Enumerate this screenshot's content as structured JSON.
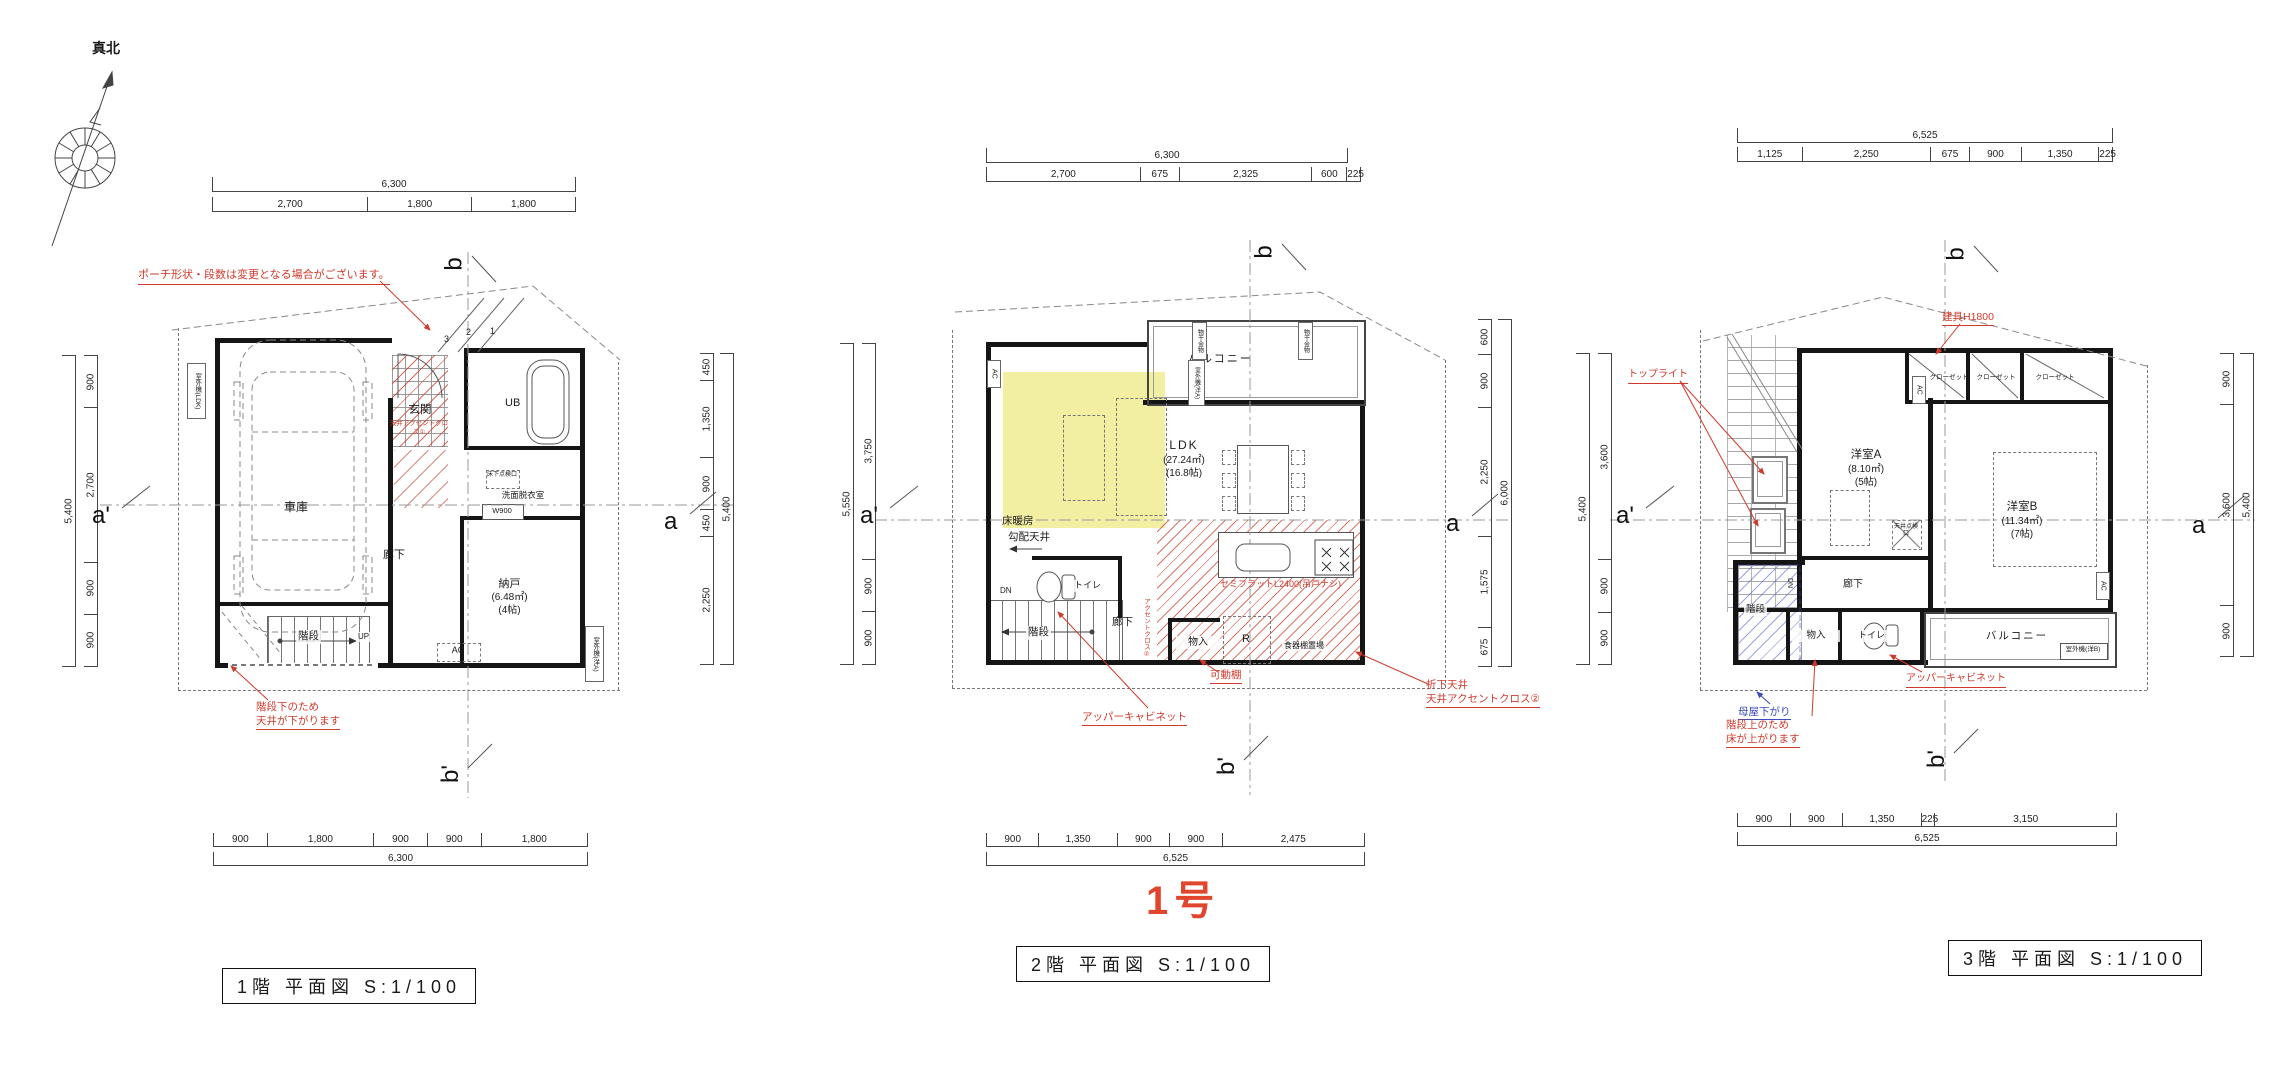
{
  "meta": {
    "north_label": "真北",
    "unit_label": "1号"
  },
  "plans": [
    {
      "id": "floor1",
      "title": "1階 平面図 S:1/100",
      "dims": {
        "top": {
          "total": "6,300",
          "segments": [
            "2,700",
            "1,800",
            "1,800"
          ]
        },
        "bottom": {
          "total": "6,300",
          "segments": [
            "900",
            "1,800",
            "900",
            "900",
            "1,800"
          ]
        },
        "left": {
          "total": "5,400",
          "segments": [
            "900",
            "2,700",
            "900",
            "900"
          ]
        },
        "right": {
          "total": "5,400",
          "segments": [
            "450",
            "1,350",
            "900",
            "450",
            "2,250"
          ]
        }
      },
      "markers": {
        "top": "b",
        "bottom": "b'",
        "left": "a'",
        "right": "a"
      },
      "rooms": {
        "garage": "車庫",
        "entrance": "玄関",
        "bath": "UB",
        "washroom": "洗面脱衣室",
        "corridor": "廊下",
        "storage": "納戸",
        "storage_area": "(6.48㎡)",
        "storage_size": "(4帖)",
        "stairs": "階段",
        "stairs_dir": "UP"
      },
      "fixtures": {
        "ac": "AC",
        "w900": "W900",
        "floor_hatch": "床下点検口",
        "outdoor_unit_ldk": "室外機(LDK)",
        "outdoor_unit_a": "室外機(洋A)"
      },
      "steps": [
        "3",
        "2",
        "1"
      ],
      "notes": {
        "porch": "ポーチ形状・段数は変更となる場合がございます。",
        "accent": "天井アクセントクロス①",
        "under_stairs": "階段下のため\n天井が下がります"
      }
    },
    {
      "id": "floor2",
      "title": "2階 平面図 S:1/100",
      "dims": {
        "top": {
          "total": "6,300",
          "segments": [
            "2,700",
            "675",
            "2,325",
            "600",
            "225"
          ]
        },
        "bottom": {
          "total": "6,525",
          "segments": [
            "900",
            "1,350",
            "900",
            "900",
            "2,475"
          ]
        },
        "left": {
          "total": "5,550",
          "segments": [
            "3,750",
            "900",
            "900"
          ]
        },
        "right": {
          "total": "6,000",
          "segments": [
            "600",
            "900",
            "2,250",
            "1,575",
            "675"
          ]
        }
      },
      "markers": {
        "top": "b",
        "bottom": "b'",
        "left": "a'",
        "right": "a"
      },
      "rooms": {
        "balcony": "バルコニー",
        "ldk": "LDK",
        "ldk_area": "(27.24㎡)",
        "ldk_size": "(16.8帖)",
        "floor_heating": "床暖房",
        "sloped_ceiling": "勾配天井",
        "toilet": "トイレ",
        "stairs": "階段",
        "stairs_dir": "DN",
        "corridor": "廊下",
        "closet": "物入",
        "fridge": "R",
        "cupboard": "食器棚置場"
      },
      "fixtures": {
        "ac": "AC",
        "laundry_hw": "物干金物",
        "outdoor_unit_a": "室外機(洋A)"
      },
      "notes": {
        "kitchen": "セミフラットL2400(吊戸ナシ)",
        "accent_wall": "アクセントクロス②",
        "movable_shelf": "可動棚",
        "upper_cabinet": "アッパーキャビネット",
        "folded_ceiling": "折下天井\n天井アクセントクロス②"
      }
    },
    {
      "id": "floor3",
      "title": "3階 平面図 S:1/100",
      "dims": {
        "top": {
          "total": "6,525",
          "segments": [
            "1,125",
            "2,250",
            "675",
            "900",
            "1,350",
            "225"
          ]
        },
        "bottom": {
          "total": "6,525",
          "segments": [
            "900",
            "900",
            "1,350",
            "225",
            "3,150"
          ]
        },
        "left": {
          "total": "5,400",
          "segments": [
            "3,600",
            "900",
            "900"
          ]
        },
        "right": {
          "total": "5,400",
          "segments": [
            "900",
            "3,600",
            "900"
          ]
        }
      },
      "markers": {
        "top": "b",
        "bottom": "b'",
        "left": "a'",
        "right": "a"
      },
      "rooms": {
        "room_a": "洋室A",
        "room_a_area": "(8.10㎡)",
        "room_a_size": "(5帖)",
        "room_b": "洋室B",
        "room_b_area": "(11.34㎡)",
        "room_b_size": "(7帖)",
        "closet": "クローゼット",
        "stairs": "階段",
        "stairs_dir": "DN",
        "storage": "物入",
        "toilet": "トイレ",
        "balcony": "バルコニー",
        "corridor": "廊下"
      },
      "fixtures": {
        "ac": "AC",
        "ceiling_hatch": "天井点検口",
        "outdoor_unit_b": "室外機(洋B)"
      },
      "notes": {
        "door": "建具H1800",
        "toplight": "トップライト",
        "upper_cabinet": "アッパーキャビネット",
        "purlin": "母屋下がり",
        "floor_up": "階段上のため\n床が上がります"
      }
    }
  ],
  "colors": {
    "annotation_red": "#cf3a2c",
    "annotation_blue": "#3c4bbf",
    "floor_heating_yellow": "#f2eea2",
    "unit_red": "#e0462e"
  }
}
